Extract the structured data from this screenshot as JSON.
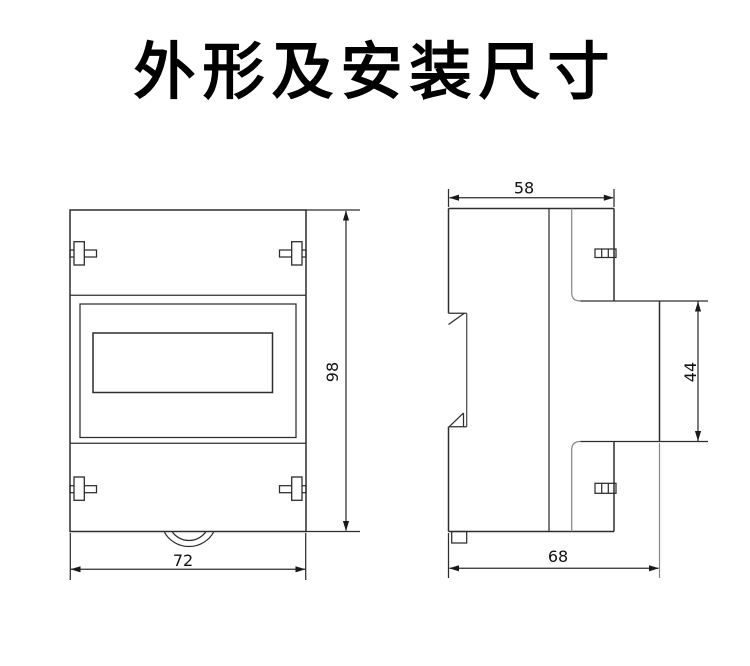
{
  "title": {
    "text": "外形及安装尺寸"
  },
  "drawing": {
    "background": "#ffffff",
    "line_color": "#2d2d2d",
    "views": [
      "front-view",
      "side-view"
    ],
    "dimensions": {
      "front_height": "98",
      "front_width": "72",
      "side_top_width": "58",
      "side_front_bezel_height": "44",
      "side_depth": "68"
    }
  }
}
